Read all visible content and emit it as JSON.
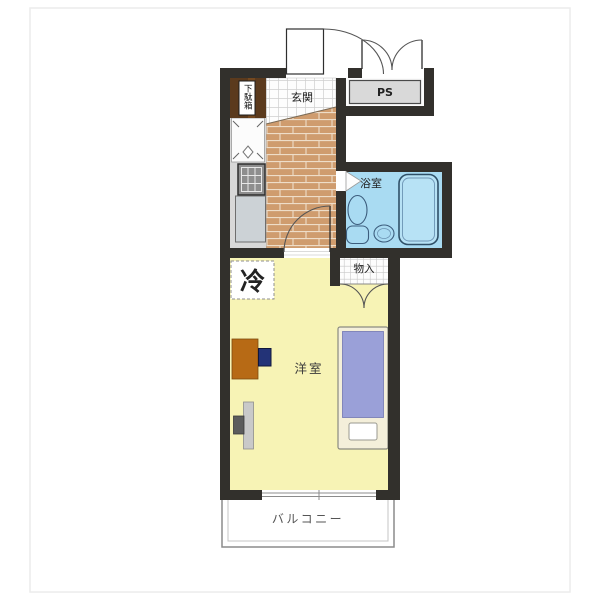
{
  "labels": {
    "genkan": "玄関",
    "shoe_cabinet": "下駄箱",
    "ps": "PS",
    "bathroom": "浴室",
    "storage": "物入",
    "fridge": "冷",
    "room": "洋室",
    "balcony": "バルコニー"
  },
  "colors": {
    "wall": "#32302c",
    "room_floor": "#f7f3b5",
    "bathroom_floor": "#a9dbf2",
    "brick": "#cf9c6e",
    "brick_mortar": "#eeddc8",
    "cabinet": "#5b3a1d",
    "ps_floor": "#d9d9d9",
    "kitchen_floor": "#d8d8d8",
    "counter": "#ccd2d6",
    "desk": "#b76a15",
    "chair": "#233377",
    "mattress": "#9aa0d8",
    "bed_frame": "#f4efda",
    "tub_fill": "#b7e2f5",
    "balcony_line": "#8c8c8c"
  }
}
